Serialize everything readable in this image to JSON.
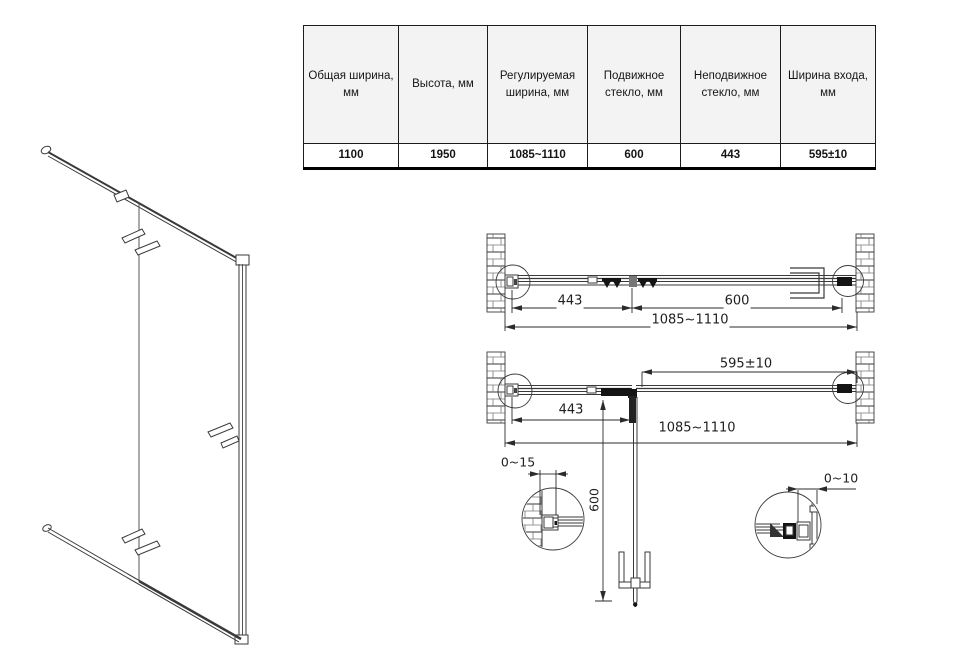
{
  "spec_table": {
    "headers": [
      "Общая ширина, мм",
      "Высота, мм",
      "Регулируемая ширина, мм",
      "Подвижное стекло, мм",
      "Неподвижное стекло, мм",
      "Ширина входа, мм"
    ],
    "values": [
      "1100",
      "1950",
      "1085~1110",
      "600",
      "443",
      "595±10"
    ]
  },
  "plan_closed": {
    "fixed_glass": "443",
    "door_glass": "600",
    "total_width": "1085~1110"
  },
  "plan_open": {
    "entry_width": "595±10",
    "fixed_glass": "443",
    "total_width": "1085~1110",
    "door_open_depth": "600"
  },
  "details": {
    "wall_profile_left_adjust": "0~15",
    "wall_profile_right_adjust": "0~10"
  },
  "colors": {
    "line": "#3a3a3a",
    "hardware": "#141414",
    "text": "#1f1f1f"
  }
}
